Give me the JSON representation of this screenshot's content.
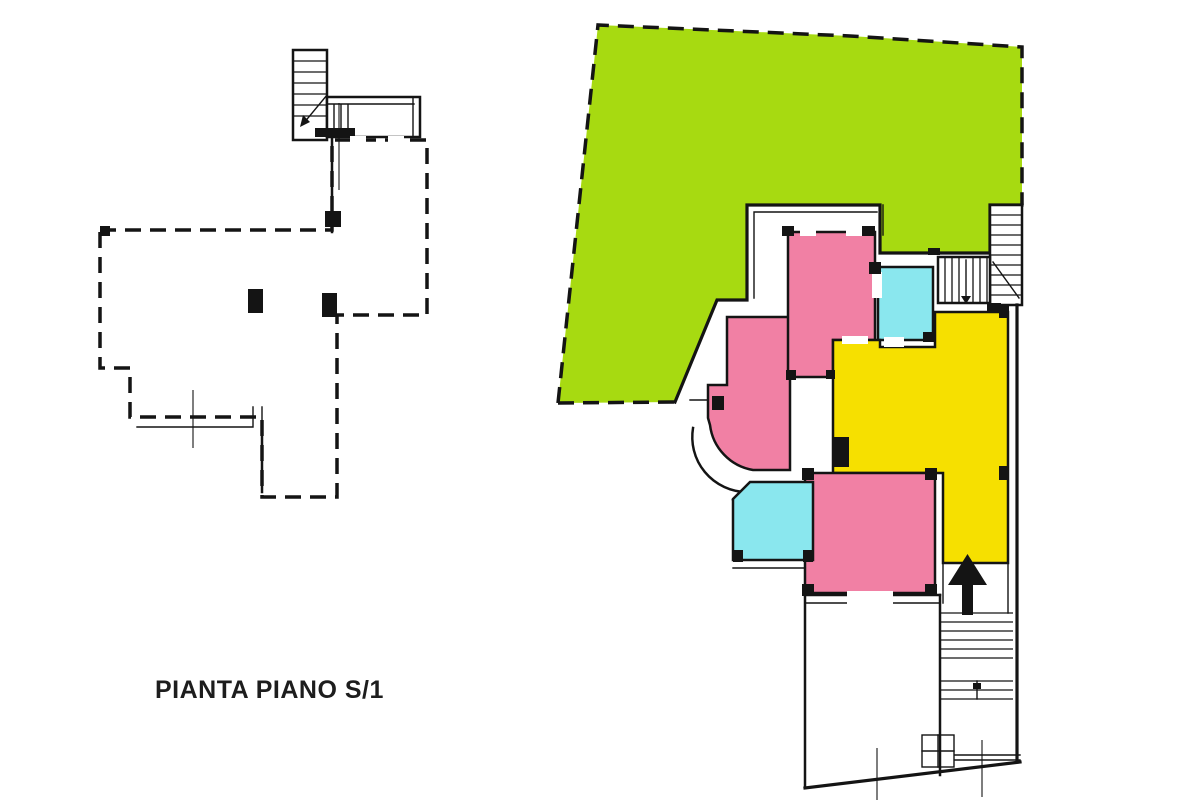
{
  "title": {
    "label": "PIANTA PIANO S/1"
  },
  "colors": {
    "garden_green": "#a7da11",
    "room_pink": "#f180a4",
    "room_cyan": "#8ae7ee",
    "room_yellow": "#f6e000",
    "wall": "#141414",
    "background": "#ffffff"
  }
}
